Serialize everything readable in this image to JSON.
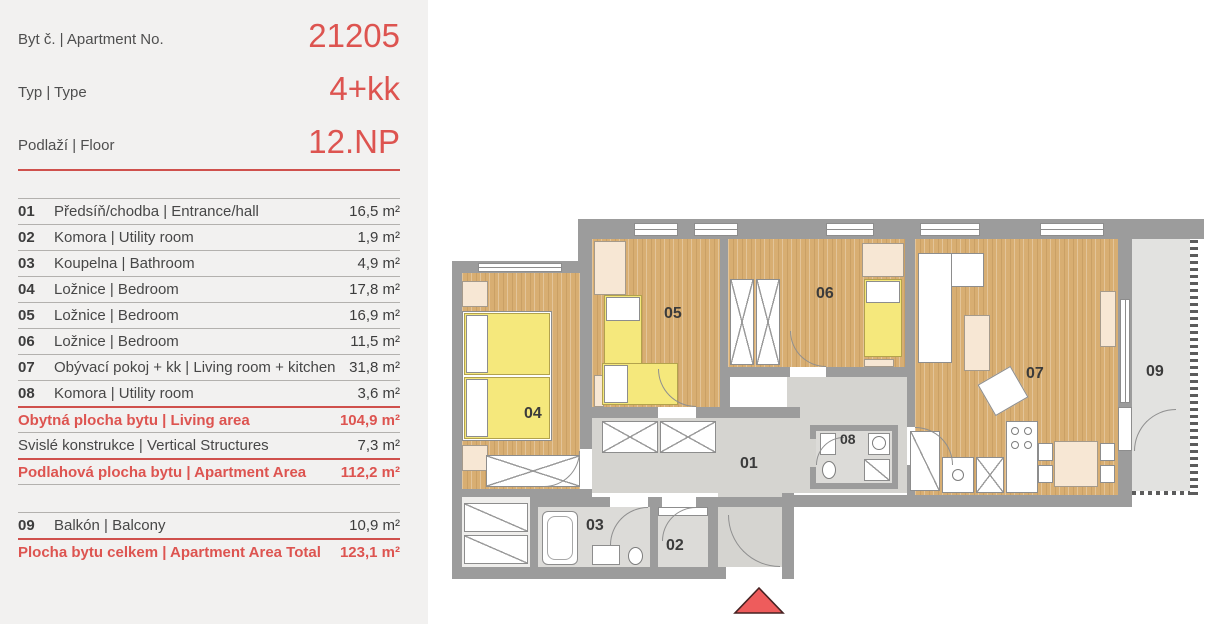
{
  "colors": {
    "accent_red": "#dd5450",
    "wall_gray": "#9c9c9c",
    "wood_floor": "#d8ae72",
    "hall_floor": "#d5d4d0",
    "balcony_floor": "#e2e2e0",
    "furniture_yellow": "#f5e87c",
    "furniture_cream": "#f7e7d4",
    "arrow_red": "#ee5c5c"
  },
  "header": {
    "rows": [
      {
        "label": "Byt č. | Apartment No.",
        "value": "21205"
      },
      {
        "label": "Typ | Type",
        "value": "4+kk"
      },
      {
        "label": "Podlaží | Floor",
        "value": "12.NP"
      }
    ]
  },
  "room_table": {
    "rows": [
      {
        "no": "01",
        "name": "Předsíň/chodba | Entrance/hall",
        "area": "16,5 m²"
      },
      {
        "no": "02",
        "name": "Komora | Utility room",
        "area": "1,9 m²"
      },
      {
        "no": "03",
        "name": "Koupelna | Bathroom",
        "area": "4,9 m²"
      },
      {
        "no": "04",
        "name": "Ložnice | Bedroom",
        "area": "17,8 m²"
      },
      {
        "no": "05",
        "name": "Ložnice | Bedroom",
        "area": "16,9 m²"
      },
      {
        "no": "06",
        "name": "Ložnice | Bedroom",
        "area": "11,5 m²"
      },
      {
        "no": "07",
        "name": "Obývací pokoj + kk | Living room + kitchen",
        "area": "31,8 m²"
      },
      {
        "no": "08",
        "name": "Komora | Utility room",
        "area": "3,6 m²"
      }
    ],
    "summary": [
      {
        "label": "Obytná plocha bytu | Living area",
        "value": "104,9 m²"
      },
      {
        "label": "Svislé konstrukce | Vertical Structures",
        "value": "7,3 m²"
      },
      {
        "label": "Podlahová plocha bytu | Apartment Area",
        "value": "112,2 m²"
      }
    ],
    "balcony": {
      "no": "09",
      "name": "Balkón | Balcony",
      "area": "10,9 m²"
    },
    "total": {
      "label": "Plocha bytu celkem | Apartment Area Total",
      "value": "123,1 m²"
    }
  },
  "plan": {
    "room_labels": [
      {
        "label": "01"
      },
      {
        "label": "02"
      },
      {
        "label": "03"
      },
      {
        "label": "04"
      },
      {
        "label": "05"
      },
      {
        "label": "06"
      },
      {
        "label": "07"
      },
      {
        "label": "08"
      },
      {
        "label": "09"
      }
    ]
  }
}
